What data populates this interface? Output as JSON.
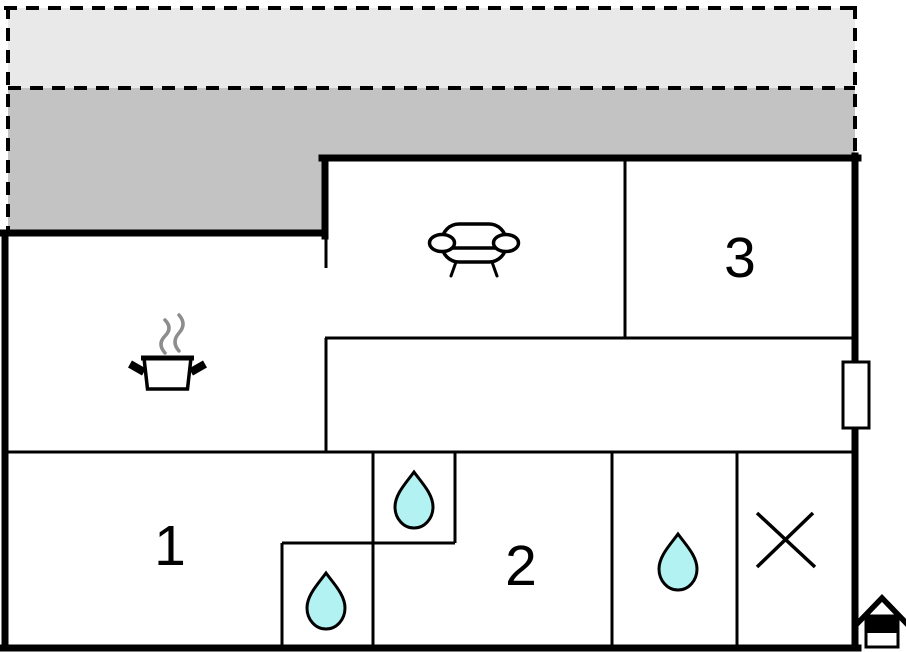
{
  "plan": {
    "kind": "holiday-home-floor-plan",
    "rooms": [
      {
        "id": "room-1",
        "label": "1"
      },
      {
        "id": "room-2",
        "label": "2"
      },
      {
        "id": "room-3",
        "label": "3"
      }
    ],
    "icons": [
      {
        "name": "sofa-icon",
        "location": "living-room"
      },
      {
        "name": "cooking-pot-icon",
        "location": "kitchen"
      },
      {
        "name": "steam-icon",
        "location": "kitchen"
      },
      {
        "name": "water-drop-icon",
        "location": "bathroom-upper"
      },
      {
        "name": "water-drop-icon",
        "location": "bathroom-lower"
      },
      {
        "name": "water-drop-icon",
        "location": "bathroom-right"
      },
      {
        "name": "x-mark-icon",
        "location": "utility-room"
      },
      {
        "name": "entrance-house-icon",
        "location": "outside-bottom-right"
      },
      {
        "name": "window-marker",
        "location": "right-wall"
      }
    ],
    "colors": {
      "background": "#ffffff",
      "wall": "#000000",
      "terrace_light": "#e9e9e9",
      "terrace_dark": "#c3c3c3",
      "water_drop": "#b3f2f2",
      "steam": "#8d8d8d"
    }
  }
}
